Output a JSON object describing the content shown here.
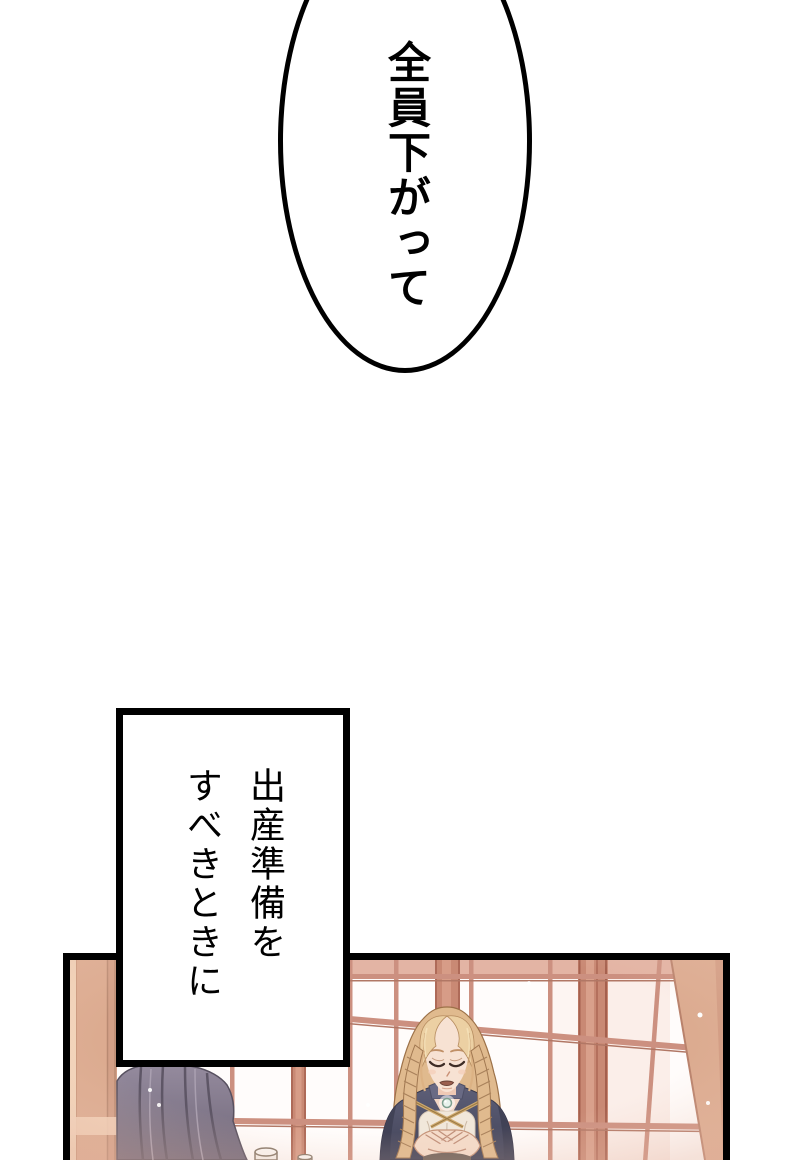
{
  "page": {
    "width": 800,
    "height": 1160
  },
  "speech_bubble": {
    "text": "全員下がって"
  },
  "caption_box": {
    "line1": "出産準備を",
    "line2": "すべきときに"
  },
  "colors": {
    "ink": "#000000",
    "paper": "#ffffff",
    "band": "#e3b4a4",
    "lattice": "#cc9080",
    "mullion": "#c98974",
    "pillar": "#dcab90",
    "cloth": "#857b8e",
    "hair": "#e0ba8e",
    "hair_light": "#ecd0a3",
    "skin": "#f7e2d3",
    "cloak": "#595a72",
    "trim": "#cfa96e",
    "gem": "#e8f2ec"
  }
}
